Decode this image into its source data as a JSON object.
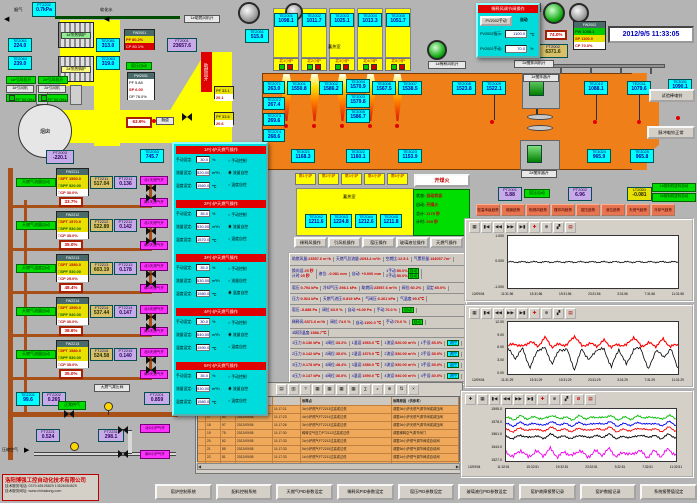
{
  "datetime": "2012/9/5 11:33:05",
  "tl": {
    "flue_gas": "烟气",
    "soft_water": "软化水",
    "chimney": "烟囱",
    "flue": "烟道",
    "boiler1": "1#余热锅炉",
    "boiler2": "2#余热锅炉",
    "fan1_on": "1#引风机开",
    "fan2_on": "2#引风机开",
    "fan1": "1#引风机",
    "fan2": "2#引风机",
    "fan_pf": "PF 50.0Hz",
    "kiln_auto": "窑压自动",
    "comb_air": "助燃风开",
    "comb_fan1": "1#助燃风机开",
    "dil_fan1": "1#稀释风机开",
    "fw2001_t": "FW2001",
    "fw2001_r1": "PF 80.2%",
    "fw2001_r2": "CP 80.1%",
    "pw2001_t": "PW2001",
    "pw2001_r1": "PF 5.88",
    "pw2001_r2": "SP 6.00",
    "pw2001_r3": "OP 78.0%",
    "valve_flue": "63.9%",
    "fp1_r1": "PF 33.1",
    "fp1_r2": "20.1",
    "fp2_r1": "PF 33.6",
    "fp2_r2": "20.6"
  },
  "s": {
    "pt2202t": {
      "id": "PT2202",
      "v": "0.7kPa"
    },
    "te2061": {
      "id": "TE2061",
      "v": "224.0"
    },
    "te2064": {
      "id": "TE2064",
      "v": "239.0"
    },
    "te2081": {
      "id": "TE2081",
      "v": "313.0"
    },
    "te2063": {
      "id": "TE2063",
      "v": "319.0"
    },
    "te2053": {
      "id": "TE2053",
      "v": "745.7"
    },
    "te2051": {
      "id": "TE2051",
      "v": "515.8"
    },
    "pt2003": {
      "id": "PT2003",
      "v": "-220.1"
    },
    "ft2001": {
      "id": "FT2001",
      "v": "23657.6"
    },
    "te2001": {
      "id": "TE2001",
      "v": "1098.1"
    },
    "te2002": {
      "id": "TE2002",
      "v": "1011.7"
    },
    "te2003": {
      "id": "TE2003",
      "v": "1025.1"
    },
    "te2004": {
      "id": "TE2004",
      "v": "1013.3"
    },
    "te2005": {
      "id": "TE2005",
      "v": "1051.7"
    },
    "te2071": {
      "id": "TE2071",
      "v": "263.0"
    },
    "te2072": {
      "id": "TE2072",
      "v": "267.4"
    },
    "te2073": {
      "id": "TE2073",
      "v": "269.6"
    },
    "te2074": {
      "id": "TE2074",
      "v": "268.6"
    },
    "te3001": {
      "id": "TE3001",
      "v": "1550.8"
    },
    "te3002": {
      "id": "TE3002",
      "v": "1586.2"
    },
    "te3004": {
      "id": "TE3004",
      "v": "1570.9"
    },
    "te3003": {
      "id": "TE3003",
      "v": "1579.8"
    },
    "te3005": {
      "id": "TE3005",
      "v": "1586.7"
    },
    "te3006": {
      "id": "TE3006",
      "v": "1567.5"
    },
    "te3007": {
      "id": "TE3007",
      "v": "1538.5"
    },
    "te2008": {
      "id": "TE2008",
      "v": "1523.8"
    },
    "te2009": {
      "id": "TE2009",
      "v": "1522.1"
    },
    "te2010": {
      "id": "TE2010",
      "v": "1088.1"
    },
    "te2011": {
      "id": "TE2011",
      "v": "1079.6"
    },
    "te3031": {
      "id": "TE3031",
      "v": "1090.1"
    },
    "te3021": {
      "id": "TE3021",
      "v": "1168.3"
    },
    "te3022": {
      "id": "TE3022",
      "v": "1160.1"
    },
    "te3023": {
      "id": "TE3023",
      "v": "1153.9"
    },
    "te3024": {
      "id": "TE3024",
      "v": "965.9"
    },
    "te3025": {
      "id": "TE3025",
      "v": "965.8"
    },
    "te2042": {
      "id": "TE2042",
      "v": "1211.6"
    },
    "te2043": {
      "id": "TE2043",
      "v": "1224.8"
    },
    "te2044": {
      "id": "TE2044",
      "v": "1212.6"
    },
    "te2045": {
      "id": "TE2045",
      "v": "1211.8"
    },
    "pt2001": {
      "id": "PT2001",
      "v": "5.88"
    },
    "pt2002": {
      "id": "PT2002",
      "v": "6.96"
    },
    "lt2001": {
      "id": "LT2001",
      "v": "-0.081"
    },
    "ft2002": {
      "id": "FT2002",
      "v": "6371.6"
    },
    "te2201": {
      "id": "TE2201",
      "v": "99.6"
    },
    "pt2202": {
      "id": "PT2202",
      "v": "0.265"
    },
    "ft2201": {
      "id": "FT2201",
      "v": "0.859"
    },
    "ft2221": {
      "id": "FT2221",
      "v": "0.524"
    },
    "ft2231": {
      "id": "FT2231",
      "v": "298.1"
    }
  },
  "regen": {
    "label": "蓄热室",
    "nb": [
      "北1小炉",
      "北2小炉",
      "北3小炉",
      "北4小炉",
      "北5小炉"
    ],
    "sb": [
      "南1小炉",
      "南2小炉",
      "南3小炉",
      "南4小炉",
      "南5小炉"
    ]
  },
  "tr": {
    "one_open": "1开",
    "popup_title": "稀释风调节阀操作",
    "pv_btn": "PV2002手动",
    "pv_auto": "自动",
    "ind_k": "PV2002指示:",
    "ind_v": "1100.0",
    "ind_u": "℃",
    "man_k": "PV2002手动:",
    "man_v": "70.0",
    "man_u": "%",
    "fw2002_t": "FW2002",
    "fw2002_r1": "PW 1098.1",
    "fw2002_r2": "SP 1100.0",
    "fw2002_r3": "CP 70.0%",
    "dil_auto": "稀释风自动",
    "valve": "74.0%",
    "stir_fan2": "2#搅拌风机开",
    "stirrer1": "1#搅拌器开",
    "stirrer2": "2#搅拌器开",
    "bell_test": "试验棒电铃",
    "bell_ok": "脉冲电铃正常"
  },
  "ign": {
    "btn": "开煤火",
    "k1": "状态:",
    "v1": "自动状态",
    "k2": "自动:",
    "v2": "开煤火",
    "k3": "总计:",
    "v3": "1175 秒",
    "k4": "计时:",
    "v4": "269 秒"
  },
  "feed": {
    "kiln_auto": "窑压自动",
    "f1": "1#投料机进料自动",
    "f2": "2#投料机进料自动"
  },
  "opb": [
    "稀释风操作",
    "引风机操作",
    "窑压操作",
    "玻璃液位操作",
    "天燃气操作"
  ],
  "trb": [
    "窑温串级趋势",
    "烟道趋势",
    "助燃风趋势",
    "搅拌风趋势",
    "窑压趋势",
    "液位趋势",
    "天燃气趋势",
    "冷却气趋势"
  ],
  "loops": [
    {
      "auto": "天燃气流量自动",
      "fw": "FW2211",
      "spt": "□SPT 1560.0",
      "spf": "□SPF 520.00",
      "cp": "□CP 30.0%",
      "ftid": "FT2211",
      "ft": "517.04",
      "ptid": "PT2211",
      "pt": "0.136",
      "valve": "33.7%",
      "n": "北1天燃气开",
      "sv": "南1天燃气开"
    },
    {
      "auto": "天燃气流量自动",
      "fw": "FW2212",
      "spt": "□SPT 1570.0",
      "spf": "□SPF 530.00",
      "cp": "□CP 35.0%",
      "ftid": "FT2212",
      "ft": "522.89",
      "ptid": "PT2212",
      "pt": "0.142",
      "valve": "35.0%",
      "n": "北2天燃气开",
      "sv": "南2天燃气开"
    },
    {
      "auto": "天燃气温度自动",
      "fw": "FW2213",
      "spt": "□SPT 1580.0",
      "spf": "□SPF 530.00",
      "cp": "□CP 25.0%",
      "ftid": "FT2213",
      "ft": "603.19",
      "ptid": "PT2213",
      "pt": "0.178",
      "valve": "48.4%",
      "n": "北3天燃气开",
      "sv": "南3天燃气开"
    },
    {
      "auto": "天燃气流量自动",
      "fw": "FW2214",
      "spt": "□SPT 1590.0",
      "spf": "□SPF 540.00",
      "cp": "□CP 30.0%",
      "ftid": "FT2214",
      "ft": "537.44",
      "ptid": "PT2214",
      "pt": "0.147",
      "valve": "38.6%",
      "n": "北4天燃气开",
      "sv": "南4天燃气开"
    },
    {
      "auto": "天燃气流量自动",
      "fw": "FW2215",
      "spt": "□SPT 1580.0",
      "spf": "□SPF 530.00",
      "cp": "□CP 35.0%",
      "ftid": "FT2215",
      "ft": "524.58",
      "ptid": "PT2215",
      "pt": "0.140",
      "valve": "35.0%",
      "n": "北5天燃气开",
      "sv": "南5天燃气开"
    }
  ],
  "pp": {
    "lm": "手动设定:",
    "lf": "流量设定:",
    "lt": "温度设定:",
    "um": "%",
    "uf": "m³/h",
    "ut": "℃",
    "sec": [
      {
        "title": "1#小炉天燃气操作",
        "man": "30.0",
        "flow": "520.00",
        "temp": "1560.0",
        "m0": "○",
        "m1": "◉",
        "m2": "○",
        "r0": "手动控制",
        "r1": "流量自控",
        "r2": "温度自控"
      },
      {
        "title": "2#小炉天燃气操作",
        "man": "35.0",
        "flow": "530.00",
        "temp": "1570.0",
        "m0": "○",
        "m1": "◉",
        "m2": "○",
        "r0": "手动控制",
        "r1": "流量自控",
        "r2": "温度自控"
      },
      {
        "title": "3#小炉天燃气操作",
        "man": "35.0",
        "flow": "530.00",
        "temp": "1580.0",
        "m0": "○",
        "m1": "○",
        "m2": "◉",
        "r0": "手动控制",
        "r1": "流量自控",
        "r2": "温度自控"
      },
      {
        "title": "4#小炉天燃气操作",
        "man": "30.0",
        "flow": "540.00",
        "temp": "1590.0",
        "m0": "○",
        "m1": "◉",
        "m2": "○",
        "r0": "手动控制",
        "r1": "流量自控",
        "r2": "温度自控"
      },
      {
        "title": "5#小炉天燃气操作",
        "man": "35.0",
        "flow": "530.00",
        "temp": "1580.0",
        "m0": "○",
        "m1": "◉",
        "m2": "○",
        "r0": "手动控制",
        "r1": "流量自控",
        "r2": "温度自控"
      }
    ]
  },
  "info": {
    "a": [
      [
        "助燃风量:",
        "23557.6 m³/h"
      ],
      [
        "天燃气总流量:",
        "2693.4 m³/h"
      ],
      [
        "空燃比:",
        "12.5:1"
      ],
      [
        "气累积量:",
        "134057.7m³"
      ]
    ],
    "b1a": "换向设:",
    "b1av": "25 秒",
    "b1b": "计时:",
    "b1bv": "25 秒",
    "b2": "液位:",
    "b2v": "-0.081 mm",
    "b3": "自动:",
    "b3v": "+0.000 mm",
    "b4a": "1手动:",
    "b4av": "50.0%",
    "b4b": "2手动:",
    "b4bv": "50.0%",
    "btag": "自动",
    "c": [
      [
        "窑压:",
        "0.794 kPa"
      ],
      [
        "冷却气压:",
        "298.1 kPa"
      ],
      [
        "助燃风:",
        "23557.6 m³/h"
      ],
      [
        "阀位:",
        "60.2%"
      ],
      [
        "设定:",
        "60.0%"
      ]
    ],
    "d": [
      [
        "压力:",
        "0.524 kPa"
      ],
      [
        "天燃气进压:",
        "0.819 kPa"
      ],
      [
        "气阀压:",
        "0.261 kPa"
      ],
      [
        "气温度:",
        "99.6℃"
      ]
    ],
    "e": [
      [
        "窑压:",
        "-5.888 Pa"
      ],
      [
        "阀位:",
        "63.9 %"
      ],
      [
        "自动:",
        "+6.00 Pa"
      ],
      [
        "手动:",
        "70.0 %"
      ]
    ],
    "etag": "自动",
    "f": [
      [
        "稀释风:",
        "6371.6 m³/h"
      ],
      [
        "阀位:",
        "74.0 %"
      ],
      [
        "自动:",
        "1100.0 ℃"
      ],
      [
        "手动:",
        "70.0 %"
      ]
    ],
    "ftag": "自动",
    "crown": "3埚顶温度:",
    "crownv": "1586.7℃",
    "bu": [
      {
        "c": [
          [
            "1压力:",
            "0.136 kPa"
          ],
          [
            "1阀位:",
            "33.2%"
          ],
          [
            "1温设:",
            "1560.0 ℃"
          ],
          [
            "1流设:",
            "520.00 m³/h"
          ],
          [
            "1手设:",
            "35.0%"
          ]
        ],
        "tag": "流控"
      },
      {
        "c": [
          [
            "2压力:",
            "0.142 kPa"
          ],
          [
            "2阀位:",
            "35.0%"
          ],
          [
            "2温设:",
            "1570.0 ℃"
          ],
          [
            "2流设:",
            "530.00 m³/h"
          ],
          [
            "2手设:",
            "35.0%"
          ]
        ],
        "tag": "流控"
      },
      {
        "c": [
          [
            "3压力:",
            "0.178 kPa"
          ],
          [
            "3阀位:",
            "48.4%"
          ],
          [
            "3温设:",
            "1580.0 ℃"
          ],
          [
            "3流设:",
            "530.00 m³/h"
          ],
          [
            "3手设:",
            "35.0%"
          ]
        ],
        "tag": "温控"
      },
      {
        "c": [
          [
            "4压力:",
            "0.147 kPa"
          ],
          [
            "4阀位:",
            "36.6%"
          ],
          [
            "4温设:",
            "1590.0 ℃"
          ],
          [
            "4流设:",
            "540.00 m³/h"
          ],
          [
            "4手设:",
            "30.0%"
          ]
        ],
        "tag": "流控"
      },
      {
        "c": [
          [
            "5压力:",
            "0.140 kPa"
          ],
          [
            "5阀位:",
            "35.0%"
          ],
          [
            "5温设:",
            "1580.0 ℃"
          ],
          [
            "5流设:",
            "530.00 m³/h"
          ],
          [
            "5手设:",
            "35.0%"
          ]
        ],
        "tag": "流控"
      }
    ]
  },
  "bl": {
    "relief": "天燃气减压阀",
    "normal": "正常供气",
    "comp_air": "压缩空气",
    "n6": "北6小炉气开",
    "s6": "南6小炉气开"
  },
  "company": {
    "name": "洛阳博强工控自动化技术有限公司",
    "tel": "技术服务电话: 0379-65105829  13526054529",
    "web": "技术服务网址: www.chinakong.com"
  },
  "alarm": {
    "hp": "故障点",
    "hc": "故障原因（供参考）",
    "rows": [
      [
        "16",
        "98",
        "2012/09/05",
        "11:17:21",
        "3#小炉燃气FT2213过高或过低",
        "调整3#小炉天燃气调节阀或减压阀"
      ],
      [
        "17",
        "84",
        "2012/09/05",
        "11:17:23",
        "4#小炉燃气FT2214过高或过低",
        "调整4#小炉天燃气调节阀或减压阀"
      ],
      [
        "18",
        "97",
        "2012/09/05",
        "11:17:26",
        "3#小炉燃气FT2213过高或过低",
        "调整3#小炉天燃气调节阀或减压阀"
      ],
      [
        "19",
        "75",
        "2012/09/05",
        "11:17:30",
        "稀释空气压力PT2112过高或过低",
        "调整稀释空气调节阀门"
      ],
      [
        "20",
        "82",
        "2012/09/05",
        "11:17:33",
        "2#小炉燃气FT2212过高或过低",
        "调整2#小炉燃气调节阀或自动阀"
      ],
      [
        "21",
        "85",
        "2012/09/05",
        "11:17:33",
        "5#小炉燃气FT2215过高或过低",
        "调整5#小炉燃气调节阀或自动阀"
      ],
      [
        "22",
        "81",
        "2012/09/05",
        "11:17:33",
        "1#小炉燃气FT2211过高或过低",
        "调整1#小炉燃气调节阀或自动阀"
      ],
      [
        "23",
        "83",
        "2012/09/05",
        "11:17:33",
        "3#小炉燃气FT2213过高或过低",
        "调整3#小炉燃气调节阀或自动阀"
      ]
    ]
  },
  "bb": [
    "窑炉控制系统",
    "配料控制系统",
    "天燃气PID参数设定",
    "稀释风PID参数设定",
    "窑压PID参数设定",
    "玻璃液位PID参数设定",
    "窑炉故障报警记录",
    "窑炉数据记录",
    "系统报警值设定"
  ],
  "tb1": [
    "▦",
    "▮◀",
    "◀◀",
    "▶▶",
    "▶▮",
    "✚",
    "⊕",
    "▞",
    "▤"
  ],
  "tb3": [
    "✚",
    "▦",
    "▮◀",
    "◀◀",
    "▶▶",
    "▶▮",
    "✚",
    "⊕",
    "▞",
    "⊘",
    "▤"
  ],
  "atb": [
    "▤",
    "▥",
    "?",
    "▦",
    "▦",
    "▦",
    "▦",
    "∑",
    "◒",
    "⊕",
    "⇅",
    "×"
  ],
  "chart_data": [
    {
      "type": "line",
      "xlabel": "time",
      "yticks": [
        "1.000",
        "0.000",
        "-1.000"
      ],
      "ylim": [
        -1.3,
        1.3
      ],
      "grid": false,
      "xticks": [
        "12/09/04",
        "11:31:56",
        "15:31:56",
        "19:31:56",
        "23:31:56",
        "3:31:56",
        "7:31:56",
        "11:31:56"
      ],
      "series": [
        {
          "color": "#000000",
          "w": 0.8,
          "jit": 0.05,
          "values": [
            0,
            0,
            0,
            0,
            0,
            0,
            0,
            0,
            0,
            0,
            0,
            0,
            0,
            0,
            0,
            0,
            0,
            0,
            0,
            0,
            0,
            0,
            0,
            0
          ]
        }
      ]
    },
    {
      "type": "line",
      "yticks": [
        "12.00",
        "9.00",
        "6.00",
        "3.00",
        "0.00"
      ],
      "ylim": [
        0,
        12.6
      ],
      "grid": false,
      "xticks": [
        "12/09/04",
        "11:31:29",
        "15:31:29",
        "19:31:29",
        "23:31:29",
        "3:31:29",
        "7:31:29",
        "11:31:29"
      ],
      "series": [
        {
          "color": "#ff0000",
          "w": 1.1,
          "jit": 0.45,
          "values": [
            6.8,
            7.3,
            6.6,
            7.9,
            6.7,
            8.8,
            6.6,
            7.2,
            7.0,
            9.3,
            6.7,
            7.4,
            6.8,
            8.1,
            6.6,
            7.1,
            6.9,
            9.0,
            6.7,
            7.5,
            6.8,
            8.4,
            6.6,
            7.2
          ]
        },
        {
          "color": "#000000",
          "w": 0.8,
          "jit": 0.5,
          "values": [
            6.0,
            3.9,
            6.1,
            1.4,
            5.9,
            6.2,
            2.5,
            6.0,
            5.8,
            1.1,
            6.1,
            3.3,
            6.0,
            5.9,
            1.7,
            6.1,
            2.2,
            6.0,
            6.2,
            0.9,
            5.9,
            4.1,
            6.0,
            1.5
          ]
        }
      ]
    },
    {
      "type": "line",
      "yticks": [
        "1595.0",
        "1578.0",
        "1561.0",
        "1544.0",
        "1527.0"
      ],
      "ylim": [
        1524,
        1598
      ],
      "grid": false,
      "xticks": [
        "12/09/04",
        "11:32:51",
        "15:32:51",
        "19:32:51",
        "23:32:51",
        "3:32:51",
        "7:32:51",
        "11:32:51"
      ],
      "series": [
        {
          "color": "#00bb00",
          "w": 0.9,
          "jit": 2.2,
          "values": [
            1586,
            1583,
            1588,
            1584,
            1587,
            1583,
            1589,
            1585,
            1586,
            1583,
            1588,
            1584,
            1587,
            1585,
            1589,
            1583,
            1586,
            1584,
            1588,
            1585,
            1587,
            1583,
            1589,
            1584
          ]
        },
        {
          "color": "#0000ee",
          "w": 0.9,
          "jit": 1.8,
          "values": [
            1577,
            1574,
            1579,
            1575,
            1578,
            1574,
            1580,
            1576,
            1577,
            1574,
            1579,
            1575,
            1578,
            1576,
            1580,
            1574,
            1577,
            1575,
            1579,
            1576,
            1578,
            1574,
            1580,
            1575
          ]
        },
        {
          "color": "#ee0000",
          "w": 0.9,
          "jit": 1.8,
          "values": [
            1569,
            1566,
            1571,
            1567,
            1570,
            1566,
            1572,
            1568,
            1569,
            1566,
            1571,
            1567,
            1570,
            1568,
            1572,
            1566,
            1569,
            1567,
            1571,
            1568,
            1570,
            1566,
            1572,
            1567
          ]
        },
        {
          "color": "#000000",
          "w": 0.9,
          "jit": 1.8,
          "values": [
            1559,
            1556,
            1561,
            1557,
            1560,
            1556,
            1562,
            1558,
            1559,
            1556,
            1561,
            1557,
            1560,
            1558,
            1562,
            1556,
            1559,
            1557,
            1561,
            1558,
            1560,
            1556,
            1562,
            1557
          ]
        },
        {
          "color": "#ee00ee",
          "w": 0.9,
          "jit": 3.5,
          "values": [
            1537,
            1530,
            1540,
            1529,
            1538,
            1532,
            1541,
            1530,
            1537,
            1531,
            1540,
            1529,
            1538,
            1533,
            1541,
            1530,
            1537,
            1532,
            1540,
            1529,
            1538,
            1531,
            1541,
            1532
          ]
        }
      ]
    }
  ]
}
